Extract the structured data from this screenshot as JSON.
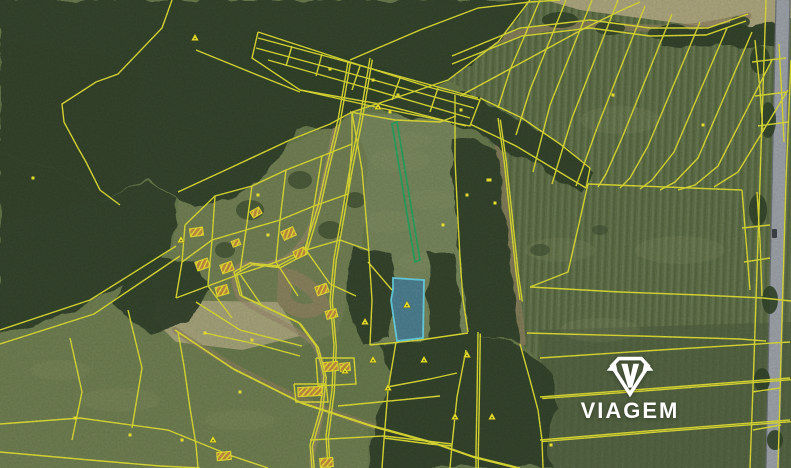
{
  "map": {
    "width": 791,
    "height": 468,
    "palette": {
      "base": "#66774a",
      "field_center": "#75845a",
      "field_right": "#5c6d44",
      "field_bottom_left": "#6d7c4f",
      "field_bottom_right": "#4e5e3d",
      "village": "#6f7d51",
      "moss": "#5d6e45",
      "forest": "#2e4026",
      "pale": "#b2aa82",
      "track": "#8d7f5c",
      "village_track": "#98876a",
      "road": "#9aa0a6",
      "road_edge": "#6b7075",
      "vehicle": "#3a3f44",
      "parcel_line": "#dcdc32",
      "building_stroke": "#e8df30",
      "building_fill": "#c08a3e",
      "green_parcel": "#22a25c",
      "highlight_fill": "rgba(38,118,186,0.55)",
      "highlight_stroke": "#64cfe0",
      "marker": "#f2ea2e",
      "marker_dot": "#6b6b1a"
    },
    "terrain": {
      "fields": [
        {
          "points": "448,80 498,42 530,0 791,0 791,468 540,468 546,444 558,410 551,371 519,342 511,288 502,215 495,148 474,128 482,100",
          "fill": "field_right",
          "striped": true
        },
        {
          "points": "540,330 791,322 791,468 545,468",
          "fill": "field_bottom_right",
          "opacity": 0.75
        },
        {
          "points": "350,112 456,118 458,220 462,300 468,332 420,338 394,341 370,344 368,250 360,170",
          "fill": "field_center"
        },
        {
          "points": "0,334 48,318 92,302 176,246 208,286 186,322 232,366 300,402 368,425 368,468 0,468",
          "fill": "field_bottom_left"
        },
        {
          "points": "180,192 282,148 352,116 368,160 362,250 338,332 300,348 238,330 194,300 172,250",
          "fill": "village"
        },
        {
          "points": "0,40 140,62 130,190 0,225",
          "fill": "moss",
          "opacity": 0.9
        }
      ],
      "pale_patches": [
        {
          "points": "545,0 791,0 791,18 762,28 700,26 640,18 580,10",
          "opacity": 0.9
        },
        {
          "points": "158,300 278,302 300,336 242,350 176,342 152,318",
          "opacity": 0.8
        }
      ],
      "forests": [
        "0,0 530,0 498,42 448,80 398,97 352,112 330,125 298,130 258,182 228,200 196,208 150,180 100,200 60,172 0,152",
        "0,152 60,172 100,200 150,182 178,198 172,250 150,268 118,288 88,304 46,320 0,334",
        "140,255 195,262 210,290 188,322 152,335 112,304",
        "250,28 360,62 480,98 560,142 592,172 580,190 540,166 470,130 378,110 298,92 250,58",
        "452,138 498,148 506,218 514,290 520,342 468,334 458,232 450,162",
        "428,250 455,255 462,335 430,340",
        "352,248 392,252 390,340 360,345 348,300",
        "380,345 470,334 520,344 552,372 560,410 545,445 555,468 368,468 376,418 392,372",
        "658,28 782,24 786,44 700,47 662,44"
      ],
      "tree_clumps": [
        [
          560,
          20,
          18,
          8,
          0.85
        ],
        [
          610,
          28,
          15,
          7,
          0.85
        ],
        [
          660,
          33,
          12,
          6,
          0.85
        ],
        [
          740,
          22,
          10,
          6,
          0.85
        ],
        [
          760,
          60,
          10,
          14,
          0.9
        ],
        [
          768,
          120,
          8,
          18,
          0.9
        ],
        [
          758,
          210,
          9,
          16,
          0.9
        ],
        [
          770,
          300,
          8,
          14,
          0.9
        ],
        [
          762,
          380,
          8,
          12,
          0.9
        ],
        [
          775,
          440,
          8,
          10,
          0.9
        ],
        [
          250,
          210,
          14,
          10,
          0.6
        ],
        [
          300,
          180,
          12,
          9,
          0.6
        ],
        [
          225,
          250,
          10,
          8,
          0.6
        ],
        [
          330,
          230,
          12,
          9,
          0.6
        ],
        [
          355,
          200,
          10,
          8,
          0.6
        ],
        [
          540,
          250,
          10,
          6,
          0.5
        ],
        [
          600,
          230,
          8,
          5,
          0.45
        ]
      ],
      "tracks": [
        {
          "d": "M 452,58 C 520,28 560,22 612,26 C 660,30 700,30 748,16",
          "width": 7,
          "color": "track",
          "opacity": 0.75
        },
        {
          "d": "M 496,120 C 500,160 508,220 514,278 C 517,300 520,325 522,342",
          "width": 8,
          "color": "track",
          "opacity": 0.7
        },
        {
          "d": "M 175,330 C 230,368 300,402 370,425 C 410,438 440,448 470,456",
          "width": 6,
          "color": "track",
          "opacity": 0.6
        },
        {
          "d": "M 348,64 C 338,120 326,170 318,206 C 305,252 282,268 252,264 C 234,262 230,275 238,296 C 250,310 285,320 312,342 C 322,355 326,375 322,408 C 318,440 310,450 312,468",
          "width": 5,
          "color": "village_track",
          "opacity": 0.65
        },
        {
          "d": "M 285,275 C 300,278 318,290 322,305 C 310,315 292,312 284,300 Z",
          "width": 14,
          "color": "track",
          "opacity": 0.8
        }
      ],
      "road": {
        "points": "776,0 790,0 779,468 766,468",
        "edges": [
          "776,0 766,468",
          "790,0 779,468"
        ],
        "vehicle": {
          "x": 772,
          "y": 229,
          "w": 5,
          "h": 9
        }
      }
    },
    "cadastral": {
      "line_width": 1.4,
      "single_lines": [
        "172,0 162,28 118,74 96,82 62,104 64,122 78,148 86,162 100,190 120,205",
        "196,50 250,72 300,92",
        "530,0 498,42 448,80 398,97 352,112",
        "178,192 230,168 290,140 330,124 352,112",
        "258,32 350,62 432,88 480,100 470,126 380,108 300,90 252,58 258,32",
        "258,38 340,60 478,98",
        "256,48 345,72 474,108",
        "268,60 360,86 470,118",
        "300,90 380,104 466,126",
        "480,98 522,118 560,144 590,168",
        "470,124 516,146 556,170 586,188",
        "590,168 586,188",
        "350,60 420,30 478,8 530,2 560,0",
        "460,96 530,58 585,28 622,10 640,2",
        "292,46 286,66",
        "322,54 316,76",
        "360,66 352,90",
        "400,78 392,100",
        "438,88 430,112",
        "185,225 215,196 252,186 286,170 322,156 352,144",
        "182,262 212,240 246,230 280,220 314,206 348,194",
        "185,225 182,262",
        "215,196 212,240",
        "252,186 246,230",
        "286,170 280,220",
        "322,156 314,206",
        "352,144 348,194",
        "182,262 176,298",
        "212,240 208,285",
        "246,230 240,272",
        "280,220 276,262",
        "314,206 306,250",
        "176,298 208,286 240,274 276,262 306,250 340,240",
        "196,302 240,330 302,346",
        "208,286 232,318",
        "240,274 262,306",
        "276,262 298,296",
        "306,250 330,284",
        "340,240 368,250",
        "330,284 356,296",
        "316,358 354,358 356,384 318,386 316,358",
        "294,384 326,384 328,402 296,402 294,384",
        "338,406 400,400 440,396",
        "310,440 384,436 452,444",
        "352,112 352,144",
        "0,330 90,300 176,246",
        "0,344 94,314 180,256",
        "178,332 184,366 190,408 196,445 198,468",
        "0,424 80,418 168,430 232,456 268,468",
        "0,452 90,460 160,466 200,468",
        "205,333 256,344 300,356",
        "70,338 82,392 72,440",
        "128,310 142,368 132,428",
        "352,112 362,170 368,240 372,300 370,345",
        "455,95 455,160 458,220 460,258 463,300 468,332",
        "350,112 395,120 440,122 456,116",
        "370,345 420,340 468,333",
        "368,262 392,290",
        "396,342 388,390 384,440 382,468",
        "466,350 457,397 452,445 450,468",
        "387,387 430,379 457,373",
        "384,438 430,444 452,446",
        "520,344 530,380 538,410 542,440 543,468",
        "588,184 742,190",
        "588,184 568,272 530,287",
        "530,287 620,292 700,295 763,298 791,301",
        "527,333 640,336 740,339 766,341",
        "742,190 746,240 750,290",
        "757,192 760,240 762,296",
        "742,228 770,225",
        "744,262 770,258",
        "755,40 760,90 763,132",
        "779,44 782,100 784,142",
        "752,62 786,58",
        "755,96 787,92",
        "758,126 788,122",
        "766,0 762,120 758,240 754,360 750,468",
        "791,60 786,180 782,320 778,468",
        "752,392 780,388",
        "753,430 781,425",
        "540,0 510,70 498,108",
        "566,0 530,90 516,135",
        "592,0 550,105 538,152 533,172",
        "618,0 572,118 558,164 552,184",
        "645,6 597,128 582,170 576,186",
        "672,14 622,138 606,174 598,187",
        "700,22 648,146 630,178 620,188",
        "727,28 674,152 652,180 640,189",
        "752,32 698,158 675,182 660,190",
        "772,60 718,166 695,185 678,190",
        "788,90 738,172 714,187",
        "452,56 520,28 590,20 650,28 708,28 748,14",
        "452,64 522,36 590,28 650,36 706,35 746,21",
        "540,358 660,350 790,342"
      ],
      "double_lines": [
        "348,62 338,120 326,170 318,206 304,252 278,266 250,263 234,272 240,295 268,308 298,322 316,346 324,376 320,410 310,445 312,468",
        "370,58 360,118 350,168 342,214 334,258 330,300 334,345 332,390 326,436 328,468",
        "175,330 232,368 300,402 370,425 432,442 472,456 520,468",
        "478,332 477,400 476,450 476,468",
        "498,118 504,160 510,215 516,272 520,300",
        "540,397 660,388 790,378",
        "540,440 660,430 790,420"
      ]
    },
    "green_parcel": {
      "points": "392,124 397,122 420,260 415,262"
    },
    "highlight_parcel": {
      "points": "393,278 424,280 423,338 397,341 391,300 393,290",
      "marker": [
        407,
        305
      ]
    },
    "buildings": [
      [
        190,
        228,
        13,
        8,
        -8
      ],
      [
        196,
        260,
        13,
        9,
        -20
      ],
      [
        221,
        263,
        12,
        9,
        -20
      ],
      [
        216,
        286,
        12,
        9,
        -15
      ],
      [
        282,
        229,
        13,
        9,
        -25
      ],
      [
        294,
        249,
        12,
        8,
        -25
      ],
      [
        316,
        285,
        12,
        9,
        -20
      ],
      [
        326,
        310,
        11,
        8,
        -15
      ],
      [
        324,
        362,
        14,
        9,
        -5
      ],
      [
        340,
        363,
        10,
        8,
        -5
      ],
      [
        298,
        387,
        24,
        9,
        -3
      ],
      [
        320,
        458,
        13,
        9,
        -5
      ],
      [
        251,
        209,
        10,
        7,
        -30
      ],
      [
        232,
        240,
        8,
        6,
        -20
      ],
      [
        217,
        452,
        14,
        8,
        -5
      ]
    ],
    "markers": {
      "triangles": [
        [
          195,
          38
        ],
        [
          181,
          240
        ],
        [
          378,
          107
        ],
        [
          365,
          322
        ],
        [
          373,
          360
        ],
        [
          388,
          388
        ],
        [
          424,
          360
        ],
        [
          467,
          355
        ],
        [
          455,
          417
        ],
        [
          492,
          417
        ],
        [
          213,
          440
        ],
        [
          345,
          371
        ]
      ],
      "dots": [
        [
          330,
          69
        ],
        [
          373,
          80
        ],
        [
          398,
          95
        ],
        [
          390,
          112
        ],
        [
          461,
          110
        ],
        [
          467,
          195
        ],
        [
          488,
          180
        ],
        [
          443,
          225
        ],
        [
          205,
          333
        ],
        [
          252,
          340
        ],
        [
          240,
          392
        ],
        [
          130,
          435
        ],
        [
          182,
          440
        ],
        [
          75,
          418
        ],
        [
          258,
          195
        ],
        [
          268,
          235
        ],
        [
          490,
          180
        ],
        [
          495,
          203
        ],
        [
          703,
          125
        ],
        [
          613,
          95
        ],
        [
          551,
          445
        ],
        [
          33,
          178
        ]
      ]
    }
  },
  "logo": {
    "label": "VIAGEM",
    "color": "#ffffff",
    "icon": "viagem-gem-icon"
  }
}
